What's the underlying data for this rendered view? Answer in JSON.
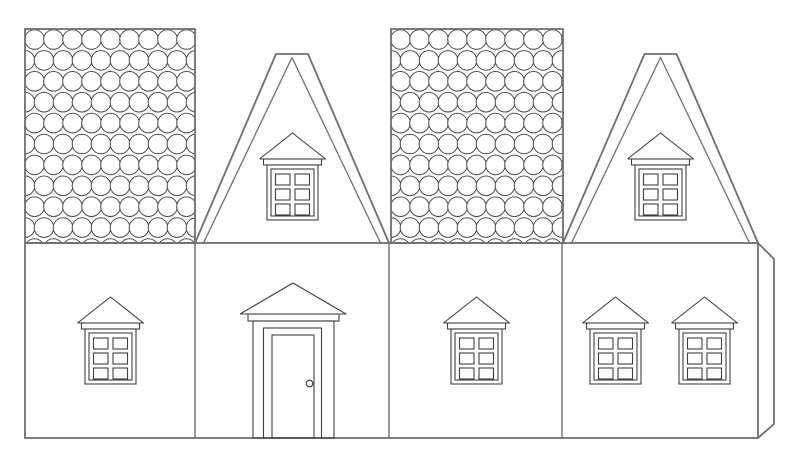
{
  "canvas": {
    "width": 800,
    "height": 468
  },
  "colors": {
    "background": "#ffffff",
    "outline": "#6f6f6f",
    "detail": "#3f3f3f",
    "shingle": "#4a4a4a",
    "fill": "#ffffff"
  },
  "scene": {
    "type": "papercraft-house-template-line-art",
    "upper_band": {
      "panels": [
        {
          "name": "roof-panel-left",
          "pattern": "fish-scale-shingles"
        },
        {
          "name": "gable-panel-left",
          "features": [
            "attic-window-with-pediment",
            "six-pane-window"
          ]
        },
        {
          "name": "roof-panel-right",
          "pattern": "fish-scale-shingles"
        },
        {
          "name": "gable-panel-right",
          "features": [
            "attic-window-with-pediment",
            "six-pane-window"
          ]
        }
      ]
    },
    "lower_band": {
      "panels": [
        {
          "name": "wall-panel-1",
          "features": [
            "six-pane-window-with-pediment"
          ]
        },
        {
          "name": "wall-panel-2",
          "features": [
            "front-door-with-pediment",
            "door-knob"
          ]
        },
        {
          "name": "wall-panel-3",
          "features": [
            "six-pane-window-with-pediment"
          ]
        },
        {
          "name": "wall-panel-4",
          "features": [
            "six-pane-window-with-pediment",
            "six-pane-window-with-pediment"
          ]
        }
      ],
      "glue_tab": {
        "name": "glue-tab-right-edge"
      }
    },
    "window_count": 6,
    "door_count": 1
  }
}
